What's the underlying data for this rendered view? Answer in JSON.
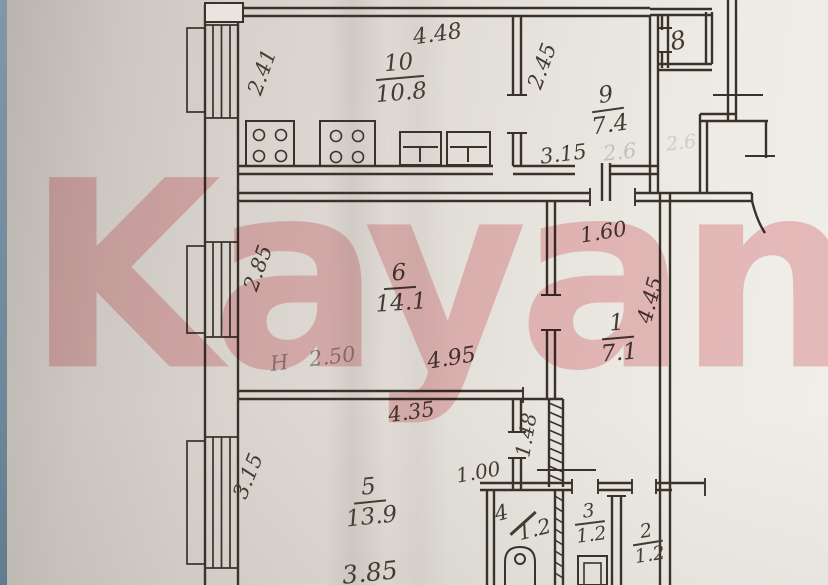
{
  "document": {
    "kind": "scanned apartment floor plan",
    "watermark": "Kayan"
  },
  "rooms": {
    "r10": {
      "number": "10",
      "area": "10.8"
    },
    "r9": {
      "number": "9",
      "area": "7.4"
    },
    "r8": {
      "number": "8"
    },
    "r6": {
      "number": "6",
      "area": "14.1"
    },
    "r1": {
      "number": "1",
      "area": "7.1"
    },
    "r5": {
      "number": "5",
      "area": "13.9"
    },
    "r4": {
      "number": "4",
      "area": "1.2"
    },
    "r3": {
      "number": "3",
      "area": "1.2"
    },
    "r2": {
      "number": "2",
      "area": "1.2"
    }
  },
  "dimensions": {
    "room10_top": "4.48",
    "room10_left": "2.41",
    "room9_left": "2.45",
    "room9_bottom": "3.15",
    "room6_left": "2.85",
    "room6_bottom": "4.95",
    "room1_top": "1.60",
    "room1_side": "4.45",
    "room5_top": "4.35",
    "room5_left": "3.15",
    "room5_bottom": "3.85",
    "corridor_length": "1.48",
    "corridor_width": "1.00"
  },
  "annotations": {
    "ceiling_height": "Н 2.50",
    "faint_mark_1": "2.6",
    "faint_mark_2": "2.6"
  },
  "colors": {
    "paper": "#ddd8d1",
    "ink": "#38322a",
    "handwriting": "#433c33",
    "watermark_pink": "#f2b9c0",
    "edge_strip_blue": "#7b90a3"
  }
}
